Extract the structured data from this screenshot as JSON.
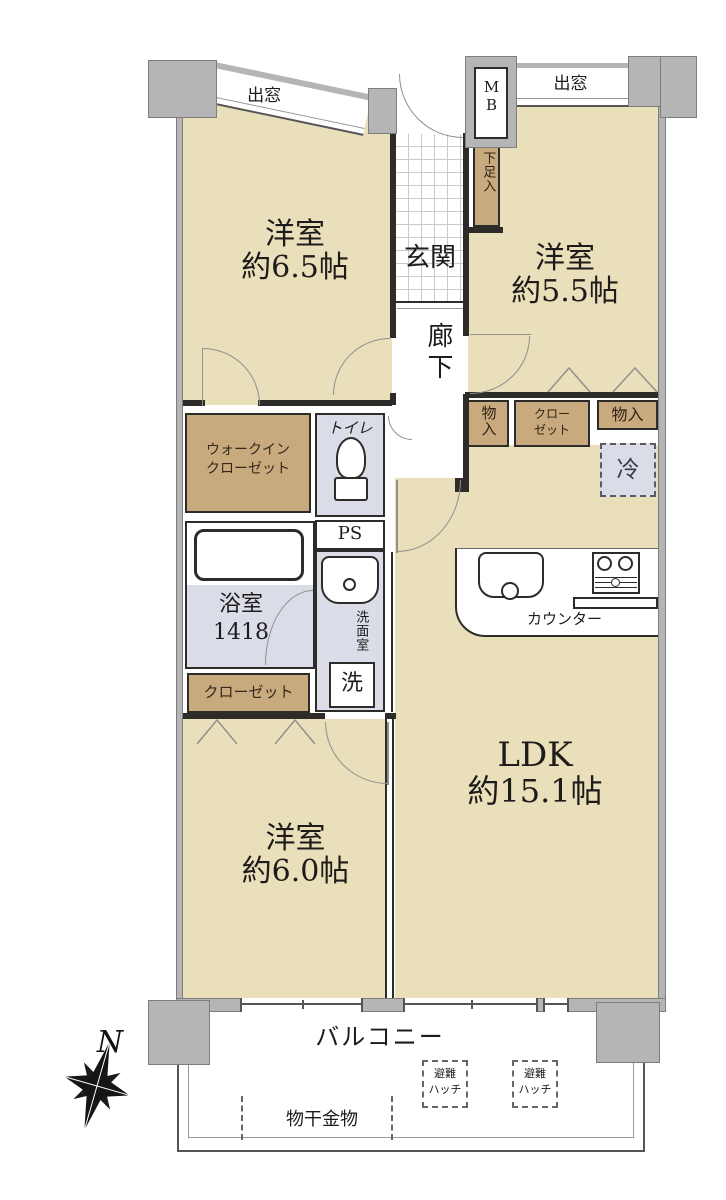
{
  "colors": {
    "room": "#e9dfba",
    "storage": "#c9aa7e",
    "wet": "#dadde8",
    "wall": "#b5b5b5",
    "line": "#2e2c29",
    "text": "#1e1c1a"
  },
  "rooms": {
    "bedroom_a": {
      "name": "洋室",
      "size": "約6.5帖"
    },
    "bedroom_b": {
      "name": "洋室",
      "size": "約5.5帖"
    },
    "bedroom_c": {
      "name": "洋室",
      "size": "約6.0帖"
    },
    "ldk": {
      "name": "LDK",
      "size": "約15.1帖"
    }
  },
  "labels": {
    "bay_window_left": "出窓",
    "bay_window_right": "出窓",
    "meter_box": "MB",
    "genkan": "玄関",
    "shoe_box": "下足入",
    "hallway": "廊下",
    "storage_top": "物入",
    "closet_top": [
      "クロー",
      "ゼット"
    ],
    "storage_right": "物入",
    "fridge": "冷",
    "wic": [
      "ウォークイン",
      "クローゼット"
    ],
    "toilet": "トイレ",
    "ps": "PS",
    "bath": [
      "浴室",
      "1418"
    ],
    "washroom": "洗面室",
    "washer": "洗",
    "closet_left": "クローゼット",
    "counter": "カウンター",
    "balcony": "バルコニー",
    "hatch": [
      "避難",
      "ハッチ"
    ],
    "laundry_fitting": "物干金物",
    "compass_north": "N"
  }
}
